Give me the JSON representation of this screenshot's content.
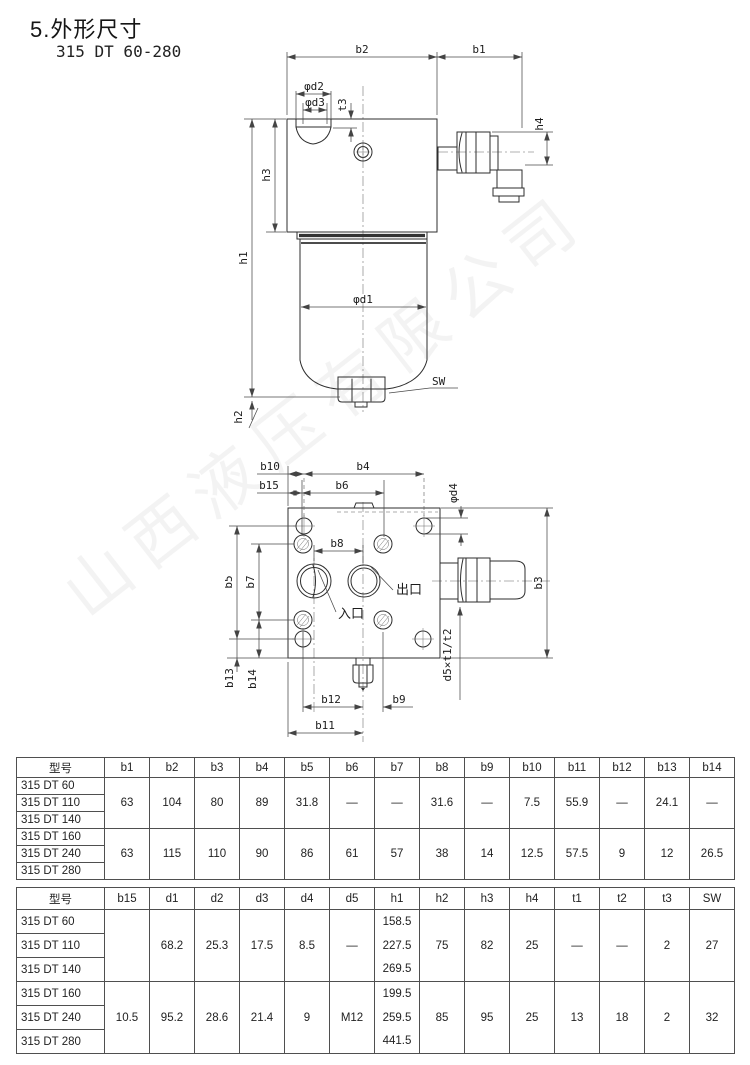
{
  "page": {
    "section_title": "5.外形尺寸",
    "model_range": "315 DT 60-280",
    "watermark": "山西液压有限公司"
  },
  "drawing1": {
    "labels": {
      "b2": "b2",
      "b1": "b1",
      "phi_d2": "φd2",
      "phi_d3": "φd3",
      "t3": "t3",
      "h3": "h3",
      "h1": "h1",
      "h2": "h2",
      "h4": "h4",
      "phi_d1": "φd1",
      "sw": "SW"
    }
  },
  "drawing2": {
    "labels": {
      "b10": "b10",
      "b4": "b4",
      "b15": "b15",
      "b6": "b6",
      "phi_d4": "φd4",
      "b3": "b3",
      "b5": "b5",
      "b7": "b7",
      "b8": "b8",
      "b13": "b13",
      "b14": "b14",
      "b12": "b12",
      "b9": "b9",
      "b11": "b11",
      "d5_thread": "d5×t1/t2",
      "inlet": "入口",
      "outlet": "出口"
    }
  },
  "table1": {
    "headers": [
      "型号",
      "b1",
      "b2",
      "b3",
      "b4",
      "b5",
      "b6",
      "b7",
      "b8",
      "b9",
      "b10",
      "b11",
      "b12",
      "b13",
      "b14"
    ],
    "groups": [
      {
        "models": [
          "315 DT 60",
          "315 DT 110",
          "315 DT 140"
        ],
        "merged": [
          "63",
          "104",
          "80",
          "89",
          "31.8",
          "—",
          "—",
          "31.6",
          "—",
          "7.5",
          "55.9",
          "—",
          "24.1",
          "—"
        ]
      },
      {
        "models": [
          "315 DT 160",
          "315 DT 240",
          "315 DT 280"
        ],
        "merged": [
          "63",
          "115",
          "110",
          "90",
          "86",
          "61",
          "57",
          "38",
          "14",
          "12.5",
          "57.5",
          "9",
          "12",
          "26.5"
        ]
      }
    ]
  },
  "table2": {
    "headers": [
      "型号",
      "b15",
      "d1",
      "d2",
      "d3",
      "d4",
      "d5",
      "h1",
      "h2",
      "h3",
      "h4",
      "t1",
      "t2",
      "t3",
      "SW"
    ],
    "groups": [
      {
        "models": [
          "315 DT 60",
          "315 DT 110",
          "315 DT 140"
        ],
        "merged_left": [
          "",
          "68.2",
          "25.3",
          "17.5",
          "8.5",
          "—"
        ],
        "h1_per_row": [
          "158.5",
          "227.5",
          "269.5"
        ],
        "merged_right": [
          "75",
          "82",
          "25",
          "—",
          "—",
          "2",
          "27"
        ]
      },
      {
        "models": [
          "315 DT 160",
          "315 DT 240",
          "315 DT 280"
        ],
        "merged_left": [
          "10.5",
          "95.2",
          "28.6",
          "21.4",
          "9",
          "M12"
        ],
        "h1_per_row": [
          "199.5",
          "259.5",
          "441.5"
        ],
        "merged_right": [
          "85",
          "95",
          "25",
          "13",
          "18",
          "2",
          "32"
        ]
      }
    ]
  }
}
